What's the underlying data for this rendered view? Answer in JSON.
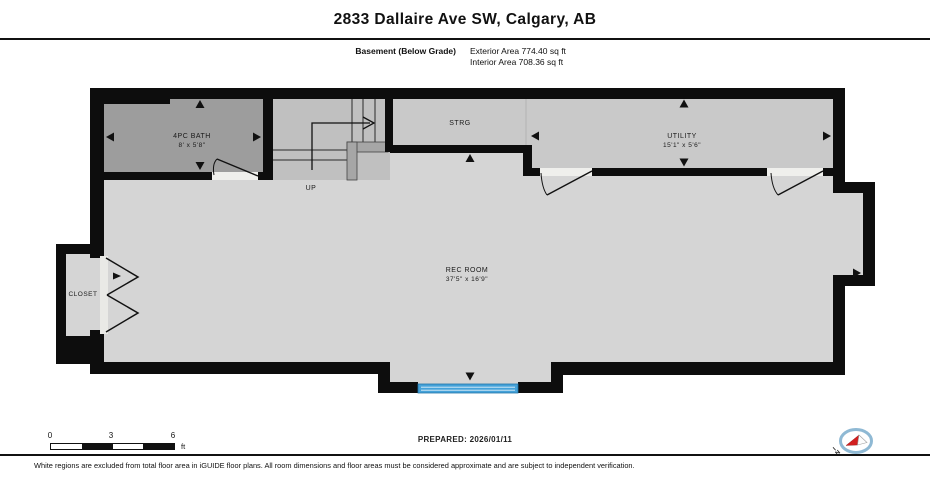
{
  "header": {
    "title": "2833 Dallaire Ave SW, Calgary, AB",
    "floor_label": "Basement (Below Grade)",
    "exterior_area": "Exterior Area 774.40 sq ft",
    "interior_area": "Interior Area 708.36 sq ft"
  },
  "rooms": {
    "bath": {
      "name": "4PC BATH",
      "dims": "8' x 5'8\""
    },
    "storage": {
      "name": "STRG"
    },
    "utility": {
      "name": "UTILITY",
      "dims": "15'1\" x 5'6\""
    },
    "rec_room": {
      "name": "REC ROOM",
      "dims": "37'5\" x 16'9\""
    },
    "closet": {
      "name": "CLOSET"
    },
    "stairs": {
      "direction_label": "UP"
    }
  },
  "scale_bar": {
    "ticks": [
      "0",
      "3",
      "6"
    ],
    "unit": "ft"
  },
  "footer": {
    "prepared": "PREPARED: 2026/01/11",
    "disclaimer": "White regions are excluded from total floor area in iGUIDE floor plans. All room dimensions and floor areas must be considered approximate and are subject to independent verification."
  },
  "compass": {
    "north_label": "N"
  },
  "colors": {
    "wall": "#0d0d0d",
    "floor_light": "#d5d5d5",
    "floor_medium": "#c9c9c9",
    "floor_stairs": "#c0c0c0",
    "floor_dark": "#9d9d9d",
    "window_blue": "#45a2d9"
  }
}
